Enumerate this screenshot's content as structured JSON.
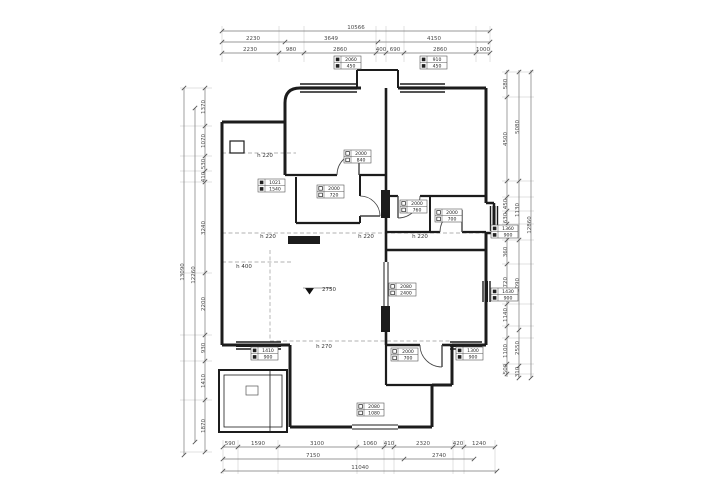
{
  "title": "residential apartment floor plan (CAD measured drawing)",
  "colors": {
    "background": "#ffffff",
    "wall": "#1c1c1c",
    "dim_line": "#777777",
    "dim_text": "#4a4a4a",
    "note_text": "#333333",
    "dashed_beam": "#999999",
    "label_box_stroke": "#555555"
  },
  "dims": {
    "top": [
      {
        "t": "10566",
        "x": 356,
        "y": 29
      },
      {
        "t": "2230",
        "x": 253,
        "y": 40
      },
      {
        "t": "3649",
        "x": 331,
        "y": 40
      },
      {
        "t": "4150",
        "x": 434,
        "y": 40
      },
      {
        "t": "2230",
        "x": 250,
        "y": 51
      },
      {
        "t": "980",
        "x": 291,
        "y": 51
      },
      {
        "t": "2860",
        "x": 340,
        "y": 51
      },
      {
        "t": "400",
        "x": 381,
        "y": 51
      },
      {
        "t": "690",
        "x": 395,
        "y": 51
      },
      {
        "t": "2860",
        "x": 440,
        "y": 51
      },
      {
        "t": "1000",
        "x": 483,
        "y": 51
      }
    ],
    "bottom": [
      {
        "t": "590",
        "x": 230,
        "y": 445
      },
      {
        "t": "1590",
        "x": 258,
        "y": 445
      },
      {
        "t": "3100",
        "x": 317,
        "y": 445
      },
      {
        "t": "1060",
        "x": 370,
        "y": 445
      },
      {
        "t": "410",
        "x": 389,
        "y": 445
      },
      {
        "t": "2320",
        "x": 423,
        "y": 445
      },
      {
        "t": "420",
        "x": 458,
        "y": 445
      },
      {
        "t": "1240",
        "x": 479,
        "y": 445
      },
      {
        "t": "7150",
        "x": 313,
        "y": 457
      },
      {
        "t": "2740",
        "x": 439,
        "y": 457
      },
      {
        "t": "11040",
        "x": 360,
        "y": 469
      }
    ],
    "left": [
      {
        "t": "13090",
        "x": 184,
        "y": 272
      },
      {
        "t": "12260",
        "x": 195,
        "y": 275
      },
      {
        "t": "1370",
        "x": 205,
        "y": 107
      },
      {
        "t": "1070",
        "x": 205,
        "y": 141
      },
      {
        "t": "530",
        "x": 205,
        "y": 164
      },
      {
        "t": "410",
        "x": 205,
        "y": 177
      },
      {
        "t": "3240",
        "x": 205,
        "y": 228
      },
      {
        "t": "2200",
        "x": 205,
        "y": 304
      },
      {
        "t": "930",
        "x": 205,
        "y": 348
      },
      {
        "t": "1410",
        "x": 205,
        "y": 381
      },
      {
        "t": "1870",
        "x": 205,
        "y": 426
      }
    ],
    "right": [
      {
        "t": "580",
        "x": 507,
        "y": 84
      },
      {
        "t": "4500",
        "x": 507,
        "y": 139
      },
      {
        "t": "450",
        "x": 507,
        "y": 204
      },
      {
        "t": "630",
        "x": 507,
        "y": 218
      },
      {
        "t": "360",
        "x": 507,
        "y": 252
      },
      {
        "t": "1720",
        "x": 507,
        "y": 284
      },
      {
        "t": "1140",
        "x": 507,
        "y": 315
      },
      {
        "t": "1100",
        "x": 507,
        "y": 351
      },
      {
        "t": "500",
        "x": 507,
        "y": 369
      },
      {
        "t": "5080",
        "x": 519,
        "y": 127
      },
      {
        "t": "1130",
        "x": 519,
        "y": 210
      },
      {
        "t": "3090",
        "x": 519,
        "y": 285
      },
      {
        "t": "2550",
        "x": 519,
        "y": 348
      },
      {
        "t": "310",
        "x": 519,
        "y": 372
      },
      {
        "t": "12860",
        "x": 531,
        "y": 225
      }
    ]
  },
  "notes": [
    {
      "t": "h 220",
      "x": 265,
      "y": 157
    },
    {
      "t": "h 220",
      "x": 268,
      "y": 238
    },
    {
      "t": "h 220",
      "x": 366,
      "y": 238
    },
    {
      "t": "h 220",
      "x": 420,
      "y": 238
    },
    {
      "t": "h 400",
      "x": 244,
      "y": 268
    },
    {
      "t": "h 270",
      "x": 324,
      "y": 348
    }
  ],
  "level_mark": {
    "t": "2750",
    "x": 322,
    "y": 291
  },
  "label_box_keys": {
    "door": [
      "门",
      "洞"
    ],
    "window": [
      "窗",
      "台"
    ]
  },
  "label_boxes": [
    {
      "type": "window",
      "x": 334,
      "y": 56,
      "rows": [
        "2060",
        "450"
      ]
    },
    {
      "type": "window",
      "x": 420,
      "y": 56,
      "rows": [
        "910",
        "450"
      ]
    },
    {
      "type": "window",
      "x": 258,
      "y": 179,
      "rows": [
        "1021",
        "1540"
      ]
    },
    {
      "type": "door",
      "x": 344,
      "y": 150,
      "rows": [
        "2000",
        "840"
      ]
    },
    {
      "type": "door",
      "x": 317,
      "y": 185,
      "rows": [
        "2000",
        "720"
      ]
    },
    {
      "type": "door",
      "x": 400,
      "y": 200,
      "rows": [
        "2000",
        "760"
      ]
    },
    {
      "type": "door",
      "x": 435,
      "y": 209,
      "rows": [
        "2000",
        "700"
      ]
    },
    {
      "type": "door",
      "x": 389,
      "y": 283,
      "rows": [
        "2080",
        "2400"
      ]
    },
    {
      "type": "door",
      "x": 391,
      "y": 348,
      "rows": [
        "2000",
        "700"
      ]
    },
    {
      "type": "window",
      "x": 456,
      "y": 347,
      "rows": [
        "1300",
        "900"
      ]
    },
    {
      "type": "window",
      "x": 251,
      "y": 347,
      "rows": [
        "1410",
        "900"
      ]
    },
    {
      "type": "window",
      "x": 491,
      "y": 225,
      "rows": [
        "1360",
        "900"
      ]
    },
    {
      "type": "window",
      "x": 491,
      "y": 288,
      "rows": [
        "1430",
        "900"
      ]
    },
    {
      "type": "door",
      "x": 357,
      "y": 403,
      "rows": [
        "2080",
        "1080"
      ]
    }
  ]
}
